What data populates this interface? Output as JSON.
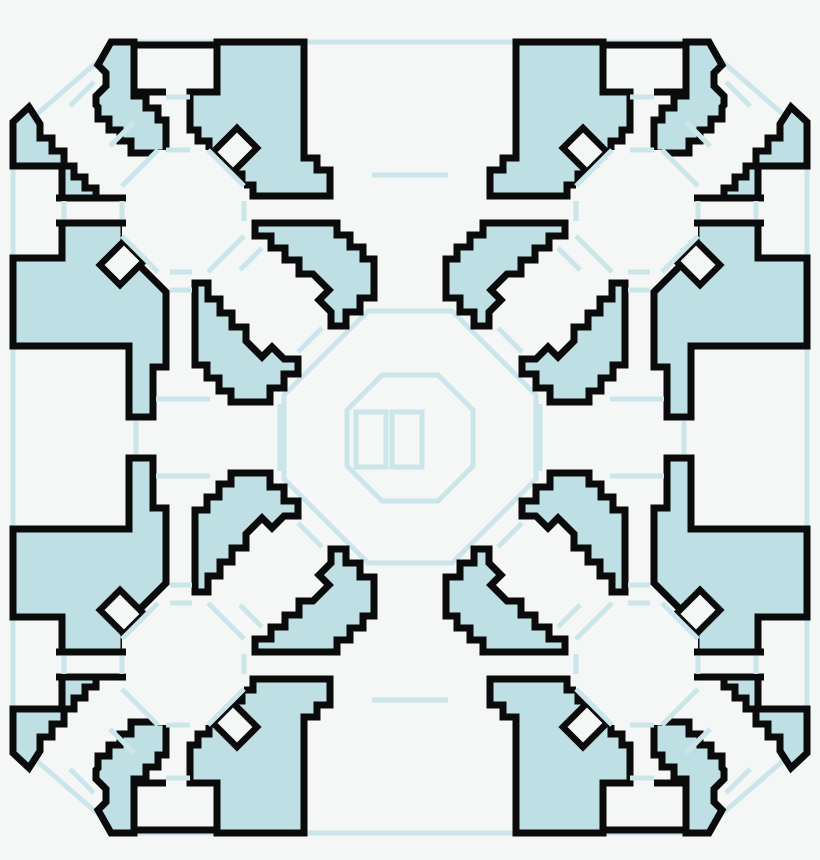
{
  "window": {
    "width": 820,
    "height": 860,
    "title": "symmetric-arena-floor-plan"
  },
  "palette": {
    "background": "#f5f6f6",
    "floor": "#f5f6f6",
    "region_fill": "#bedfe4",
    "outline": "#0b0b0b",
    "guide_line": "#cbe6eb"
  },
  "map": {
    "kind": "symmetric arena floor plan",
    "symmetry": "4-fold mirror symmetry (quadrants reflected about both axes)",
    "outer_boundary": "octagon with cut corners drawn as thin light-blue guide line",
    "hub_rooms": 4,
    "hub_shape": "octagon with 8 radiating passages",
    "central_room_shape": "large octagon",
    "central_platform": {
      "shape": "small octagon",
      "inner_rectangles": 2
    },
    "edge_rooms": 4,
    "corner_alcove_rooms": 8,
    "junction_rooms": 4,
    "door_marker_color": "#cbe6eb",
    "wall_color": "#0b0b0b",
    "solid_region_color": "#bedfe4"
  }
}
